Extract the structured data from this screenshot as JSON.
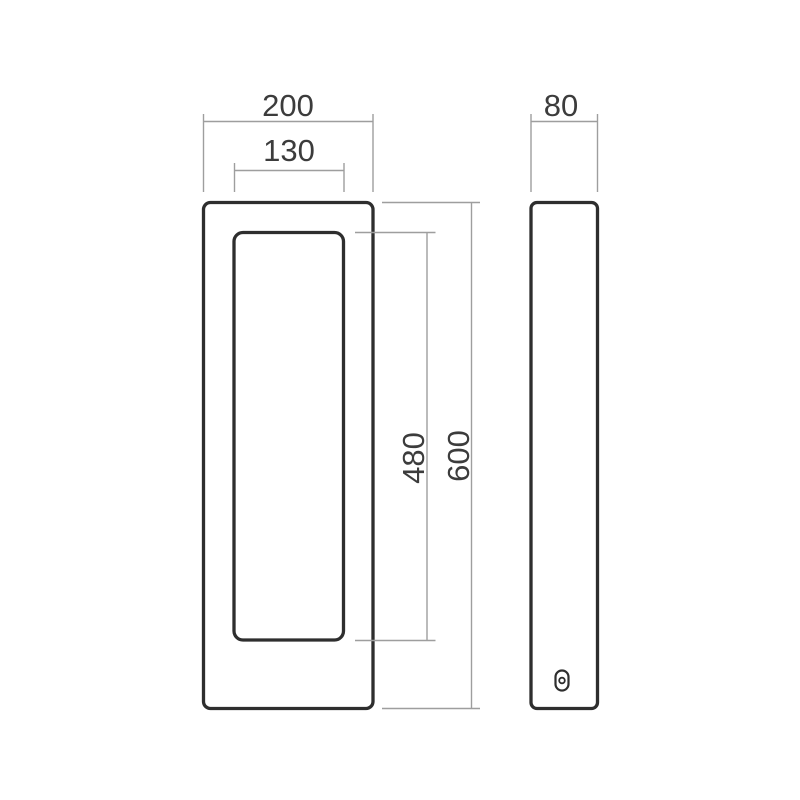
{
  "colors": {
    "background": "#ffffff",
    "outline": "#2e2e2e",
    "dimension_line": "#9e9e9e",
    "label_text": "#3c3c3c"
  },
  "views": {
    "front": {
      "dimensions": {
        "outer_width": "200",
        "inner_width": "130",
        "outer_height": "600",
        "inner_height": "480"
      }
    },
    "side": {
      "dimensions": {
        "depth": "80"
      }
    }
  }
}
